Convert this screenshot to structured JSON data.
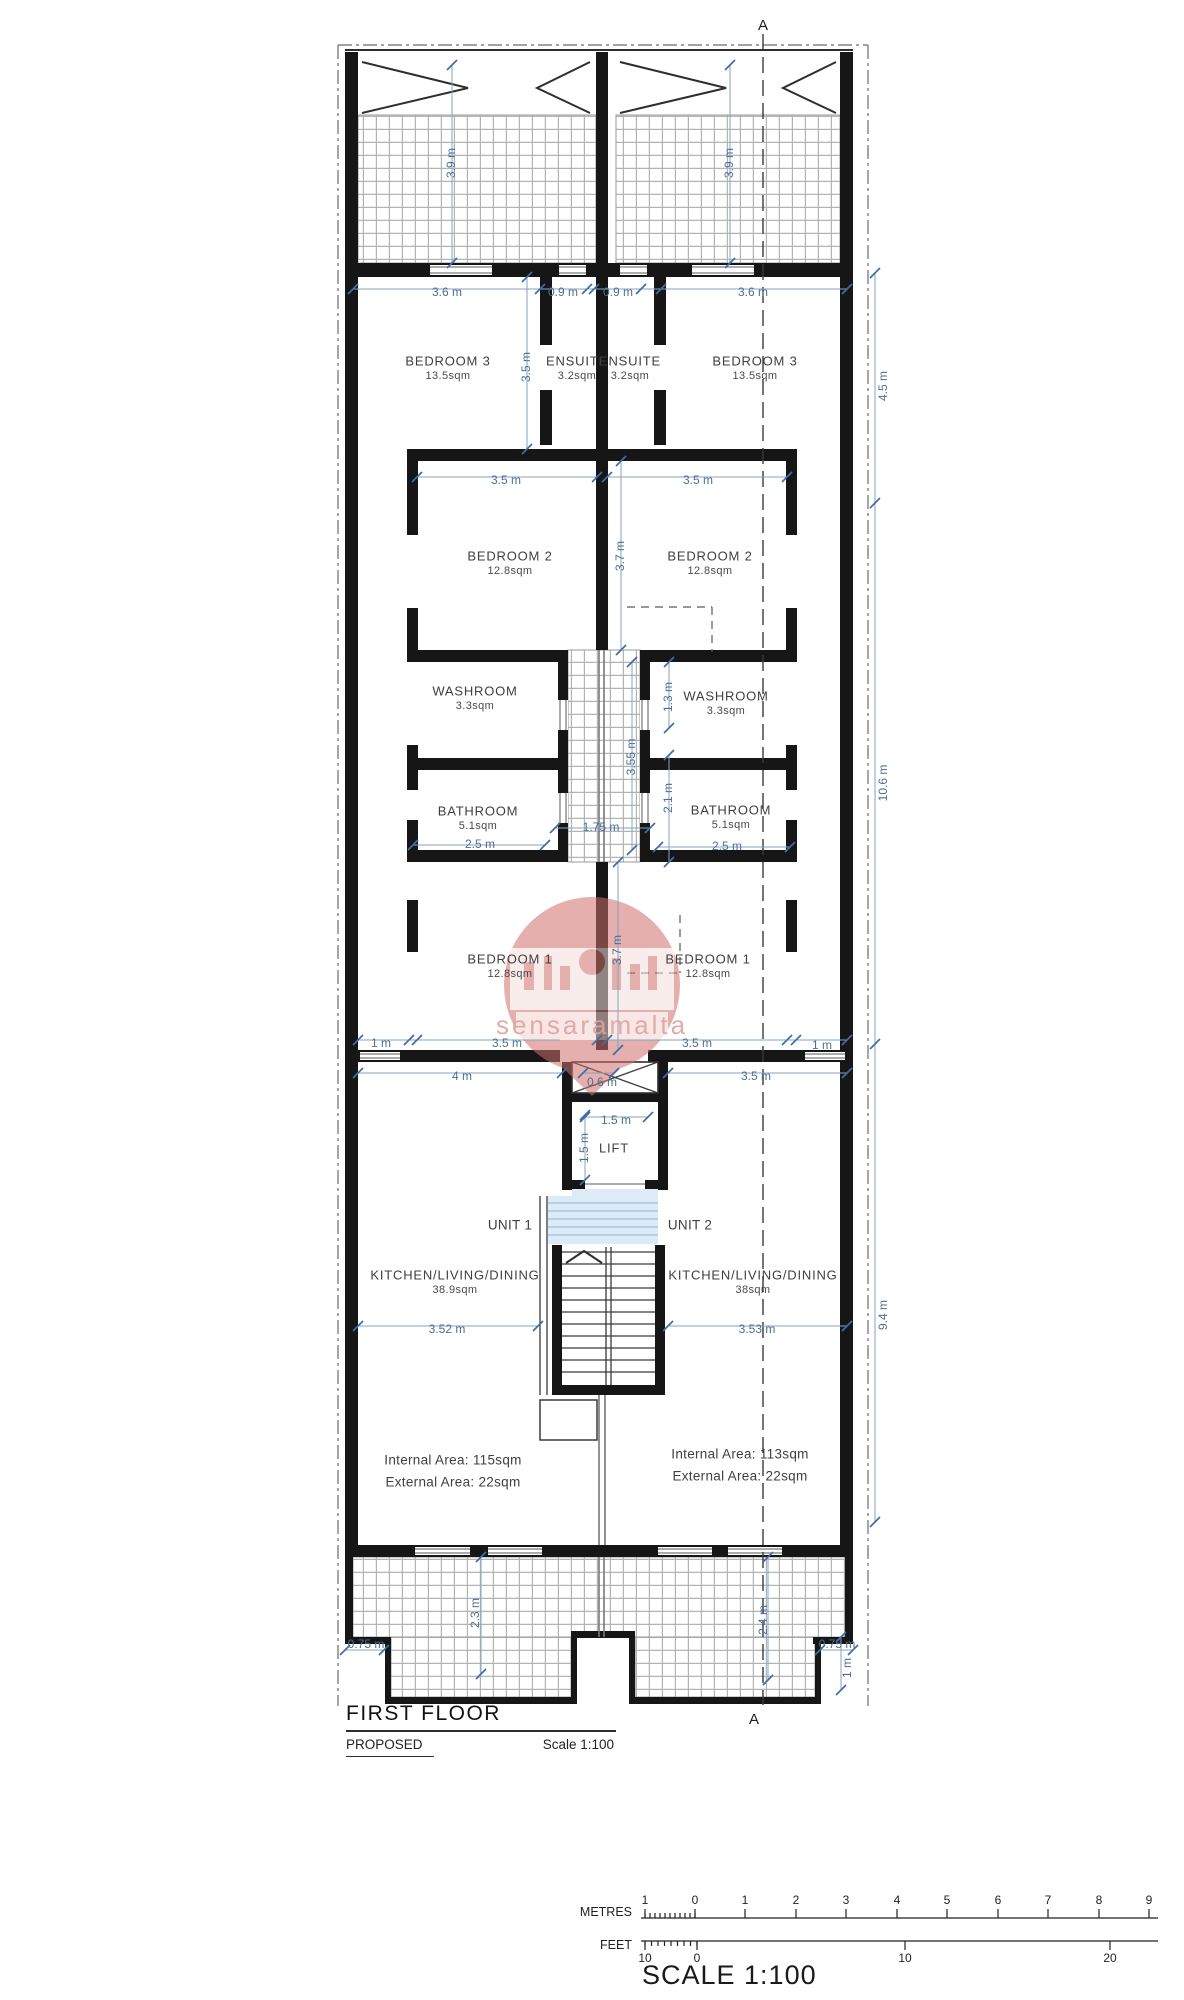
{
  "title_block": {
    "title": "FIRST FLOOR",
    "subtitle": "PROPOSED",
    "scale_note": "Scale 1:100"
  },
  "footer": {
    "scale_heading": "SCALE 1:100",
    "metres_label": "METRES",
    "feet_label": "FEET",
    "metres_ticks": [
      {
        "t": "1",
        "x": 645
      },
      {
        "t": "0",
        "x": 695
      },
      {
        "t": "1",
        "x": 745
      },
      {
        "t": "2",
        "x": 796
      },
      {
        "t": "3",
        "x": 846
      },
      {
        "t": "4",
        "x": 897
      },
      {
        "t": "5",
        "x": 947
      },
      {
        "t": "6",
        "x": 998
      },
      {
        "t": "7",
        "x": 1048
      },
      {
        "t": "8",
        "x": 1099
      },
      {
        "t": "9",
        "x": 1149
      }
    ],
    "feet_ticks": [
      {
        "t": "10",
        "x": 645
      },
      {
        "t": "0",
        "x": 697
      },
      {
        "t": "10",
        "x": 905
      },
      {
        "t": "20",
        "x": 1110
      }
    ]
  },
  "section": {
    "label": "A",
    "top": {
      "x": 763,
      "y": 26
    },
    "bottom": {
      "x": 754,
      "y": 1720
    }
  },
  "watermark": {
    "text": "sensaramalta"
  },
  "colors": {
    "dimension": "#4e6f92",
    "wall": "#161616",
    "watermark_pink": "#cf6f6a",
    "landing_blue": "#dcebf6"
  },
  "units": [
    {
      "label": "UNIT 1",
      "x": 510,
      "y": 1226
    },
    {
      "label": "UNIT 2",
      "x": 690,
      "y": 1226
    }
  ],
  "rooms": [
    {
      "name": "BEDROOM 3",
      "area": "13.5sqm",
      "x": 448,
      "y": 362
    },
    {
      "name": "ENSUITE",
      "area": "3.2sqm",
      "x": 577,
      "y": 362
    },
    {
      "name": "ENSUITE",
      "area": "3.2sqm",
      "x": 630,
      "y": 362
    },
    {
      "name": "BEDROOM 3",
      "area": "13.5sqm",
      "x": 755,
      "y": 362
    },
    {
      "name": "BEDROOM 2",
      "area": "12.8sqm",
      "x": 510,
      "y": 557
    },
    {
      "name": "BEDROOM 2",
      "area": "12.8sqm",
      "x": 710,
      "y": 557
    },
    {
      "name": "WASHROOM",
      "area": "3.3sqm",
      "x": 475,
      "y": 692
    },
    {
      "name": "WASHROOM",
      "area": "3.3sqm",
      "x": 726,
      "y": 697
    },
    {
      "name": "BATHROOM",
      "area": "5.1sqm",
      "x": 478,
      "y": 812
    },
    {
      "name": "BATHROOM",
      "area": "5.1sqm",
      "x": 731,
      "y": 811
    },
    {
      "name": "BEDROOM 1",
      "area": "12.8sqm",
      "x": 510,
      "y": 960
    },
    {
      "name": "BEDROOM 1",
      "area": "12.8sqm",
      "x": 708,
      "y": 960
    },
    {
      "name": "LIFT",
      "area": "",
      "x": 614,
      "y": 1149
    },
    {
      "name": "KITCHEN/LIVING/DINING",
      "area": "38.9sqm",
      "x": 455,
      "y": 1276
    },
    {
      "name": "KITCHEN/LIVING/DINING",
      "area": "38sqm",
      "x": 753,
      "y": 1276
    }
  ],
  "unit_areas": [
    {
      "line1": "Internal Area: 115sqm",
      "line2": "External Area: 22sqm",
      "x": 453,
      "y": 1461
    },
    {
      "line1": "Internal Area: 113sqm",
      "line2": "External Area: 22sqm",
      "x": 740,
      "y": 1455
    }
  ],
  "dimensions": [
    {
      "t": "3.9 m",
      "x": 452,
      "y": 163,
      "r": -90
    },
    {
      "t": "3.9 m",
      "x": 730,
      "y": 163,
      "r": -90
    },
    {
      "t": "3.6 m",
      "x": 447,
      "y": 293
    },
    {
      "t": "0.9 m",
      "x": 563,
      "y": 293
    },
    {
      "t": "0.9 m",
      "x": 618,
      "y": 293
    },
    {
      "t": "3.6 m",
      "x": 753,
      "y": 293
    },
    {
      "t": "4.5 m",
      "x": 884,
      "y": 386,
      "r": -90
    },
    {
      "t": "3.5 m",
      "x": 527,
      "y": 367,
      "r": -90
    },
    {
      "t": "3.5 m",
      "x": 506,
      "y": 481
    },
    {
      "t": "3.5 m",
      "x": 698,
      "y": 481
    },
    {
      "t": "3.7 m",
      "x": 621,
      "y": 556,
      "r": -90
    },
    {
      "t": "1.3 m",
      "x": 669,
      "y": 697,
      "r": -90
    },
    {
      "t": "3.55 m",
      "x": 632,
      "y": 757,
      "r": -90
    },
    {
      "t": "2.1 m",
      "x": 669,
      "y": 798,
      "r": -90
    },
    {
      "t": "1.75 m",
      "x": 601,
      "y": 828
    },
    {
      "t": "2.5 m",
      "x": 480,
      "y": 845
    },
    {
      "t": "2.5 m",
      "x": 727,
      "y": 847
    },
    {
      "t": "10.6 m",
      "x": 884,
      "y": 783,
      "r": -90
    },
    {
      "t": "3.7 m",
      "x": 618,
      "y": 950,
      "r": -90
    },
    {
      "t": "1 m",
      "x": 381,
      "y": 1044
    },
    {
      "t": "3.5 m",
      "x": 507,
      "y": 1044
    },
    {
      "t": "3.5 m",
      "x": 697,
      "y": 1044
    },
    {
      "t": "1 m",
      "x": 822,
      "y": 1046
    },
    {
      "t": "4 m",
      "x": 462,
      "y": 1077
    },
    {
      "t": "0.6 m",
      "x": 602,
      "y": 1083
    },
    {
      "t": "3.5 m",
      "x": 756,
      "y": 1077
    },
    {
      "t": "1.5 m",
      "x": 616,
      "y": 1121
    },
    {
      "t": "1.5 m",
      "x": 585,
      "y": 1148,
      "r": -90
    },
    {
      "t": "3.52 m",
      "x": 447,
      "y": 1330
    },
    {
      "t": "3.53 m",
      "x": 757,
      "y": 1330
    },
    {
      "t": "9.4 m",
      "x": 884,
      "y": 1315,
      "r": -90
    },
    {
      "t": "0.75 m",
      "x": 366,
      "y": 1645
    },
    {
      "t": "2.3 m",
      "x": 476,
      "y": 1613,
      "r": -90
    },
    {
      "t": "2.4 m",
      "x": 764,
      "y": 1620,
      "r": -90
    },
    {
      "t": "0.75 m",
      "x": 837,
      "y": 1645
    },
    {
      "t": "1 m",
      "x": 848,
      "y": 1668,
      "r": -90
    }
  ]
}
